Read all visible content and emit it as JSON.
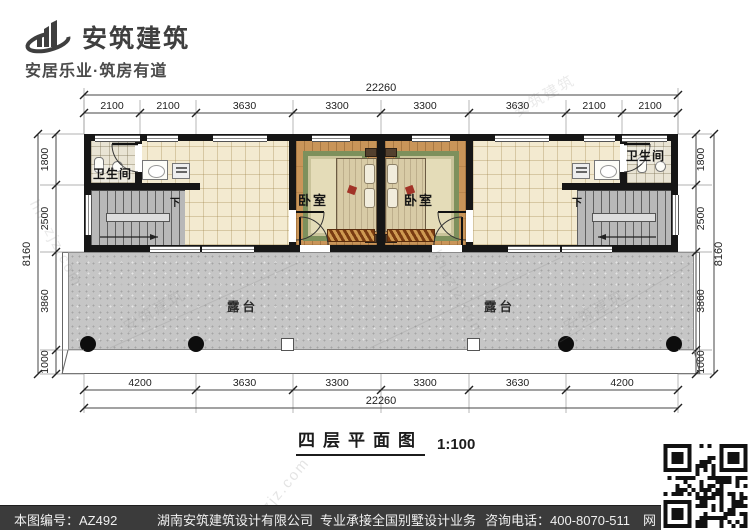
{
  "brand": {
    "name": "安筑建筑",
    "tagline": "安居乐业·筑房有道",
    "logo_icon": "building-swoosh-logo"
  },
  "plan": {
    "title": "四层平面图",
    "scale": "1:100",
    "rooms": {
      "bathroom": "卫生间",
      "bedroom": "卧室",
      "terrace": "露台",
      "stairs_down": "下"
    },
    "dimensions": {
      "top": {
        "overall": "22260",
        "segments": [
          "2100",
          "2100",
          "3630",
          "3300",
          "3300",
          "3630",
          "2100",
          "2100"
        ]
      },
      "bottom": {
        "overall": "22260",
        "segments": [
          "4200",
          "3630",
          "3300",
          "3300",
          "3630",
          "4200"
        ]
      },
      "left": {
        "overall": "8160",
        "segments": [
          "1800",
          "2500",
          "3860",
          "1000"
        ]
      },
      "right": {
        "overall": "8160",
        "segments": [
          "1800",
          "2500",
          "3860",
          "1000"
        ]
      }
    }
  },
  "watermarks": [
    "安筑建筑",
    "hnazjz.com"
  ],
  "footer": {
    "plan_number": "本图编号：AZ492",
    "company": "湖南安筑建筑设计有限公司",
    "services": "专业承接全国别墅设计业务",
    "phone": "咨询电话：400-8070-511",
    "web_char": "网",
    "qr_icon": "qr-code"
  },
  "colors": {
    "wall": "#161616",
    "terrace": "#c6c6c6",
    "wood_floor": "#c99559",
    "hall_tile": "#f3ead0",
    "footer_bg": "#3b3b3b",
    "brand_gray": "#3f3f3f"
  }
}
